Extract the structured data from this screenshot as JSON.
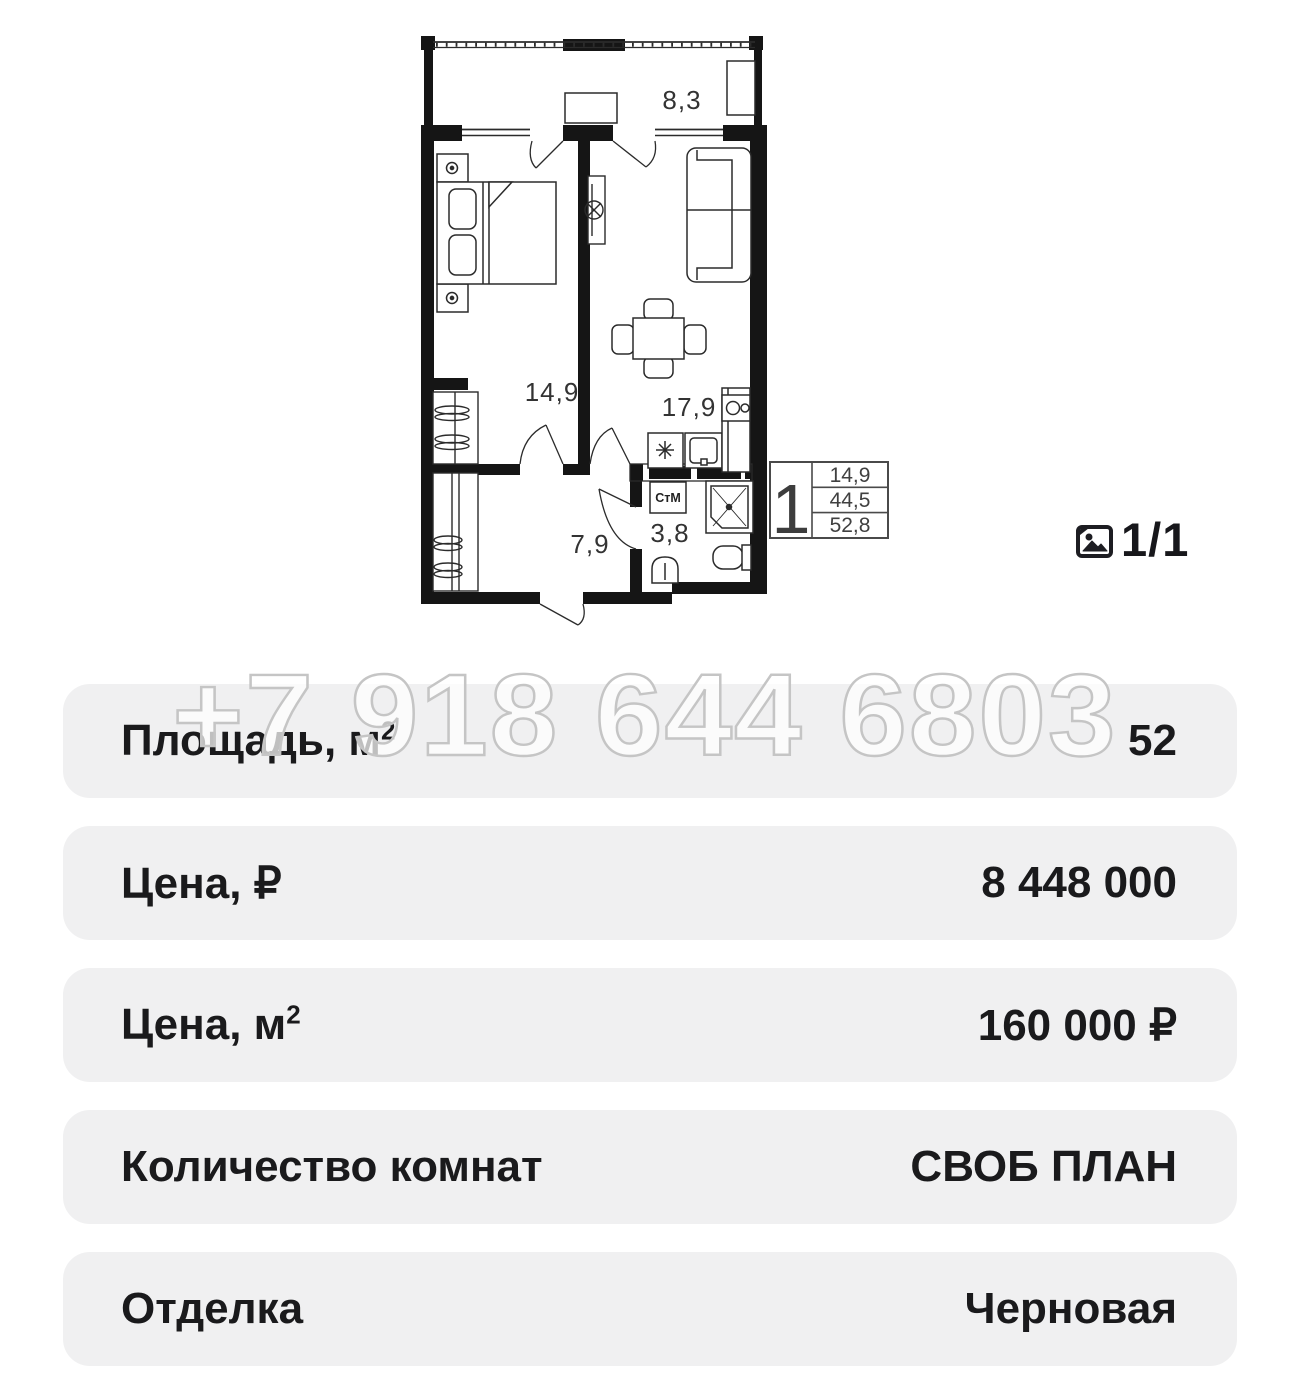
{
  "colors": {
    "card_bg": "#f0f0f1",
    "text_primary": "#1a1a1c",
    "plan_walls": "#151515",
    "plan_lines": "#2b2b2b",
    "watermark_stroke": "#c5c5c5"
  },
  "floor_plan": {
    "room_labels": {
      "balcony": "8,3",
      "bedroom": "14,9",
      "kitchen_living": "17,9",
      "hallway": "7,9",
      "bathroom": "3,8"
    },
    "washer_label": "СтМ",
    "legend": {
      "rooms_count": "1",
      "living_area": "14,9",
      "area_without_balcony": "44,5",
      "total_area": "52,8"
    }
  },
  "gallery": {
    "counter": "1/1"
  },
  "watermark_phone": "+7 918 644 6803",
  "details_rows": [
    {
      "label": "Площадь, м",
      "sup": "2",
      "value": "52"
    },
    {
      "label": "Цена, ₽",
      "sup": "",
      "value": "8 448 000"
    },
    {
      "label": "Цена, м",
      "sup": "2",
      "value": "160 000 ₽"
    },
    {
      "label": "Количество комнат",
      "sup": "",
      "value": "СВОБ ПЛАН"
    },
    {
      "label": "Отделка",
      "sup": "",
      "value": "Черновая"
    }
  ]
}
